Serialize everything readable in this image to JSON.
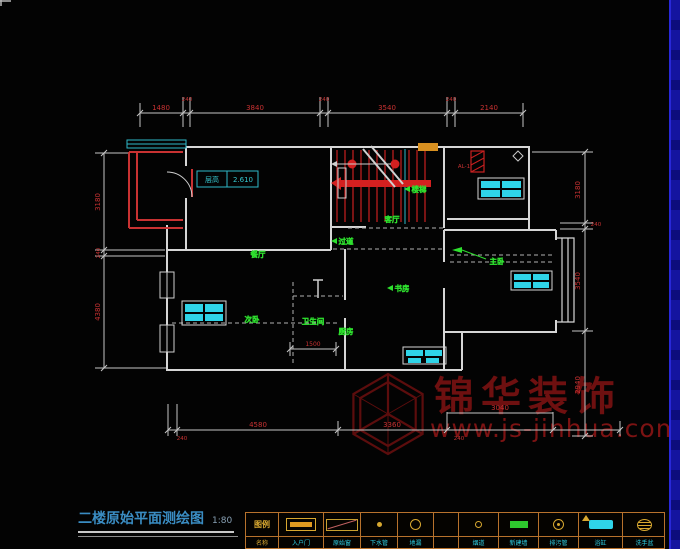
{
  "meta": {
    "title": "二楼原始平面测绘图",
    "scale": "1:80"
  },
  "height_note": {
    "label": "层高",
    "value": "2.610"
  },
  "flue_label": "AL-1",
  "rooms": [
    {
      "label": "餐厅"
    },
    {
      "label": "过道"
    },
    {
      "label": "客厅"
    },
    {
      "label": "楼梯"
    },
    {
      "label": "主卧"
    },
    {
      "label": "书房"
    },
    {
      "label": "卫生间"
    },
    {
      "label": "次卧"
    },
    {
      "label": "厨房"
    }
  ],
  "dims": {
    "top": [
      "1480",
      "240",
      "3840",
      "240",
      "3540",
      "240",
      "2140"
    ],
    "left": [
      "3180",
      "240",
      "4380"
    ],
    "right": [
      "3180",
      "240",
      "3540",
      "2940"
    ],
    "bottom": [
      "240",
      "4580",
      "3360",
      "3040",
      "240"
    ],
    "interior": [
      "1500"
    ]
  },
  "watermark": {
    "brand": "锦华装饰",
    "url": "www.js-jinhua.com"
  },
  "legend": {
    "items": [
      {
        "symbol": "label",
        "top": "图例",
        "name": "名称"
      },
      {
        "symbol": "door",
        "name": "入户门"
      },
      {
        "symbol": "window",
        "name": "原始窗"
      },
      {
        "symbol": "dot",
        "name": "下水管"
      },
      {
        "symbol": "circle",
        "name": "地漏"
      },
      {
        "symbol": "empty",
        "name": ""
      },
      {
        "symbol": "small-circle",
        "name": "烟道"
      },
      {
        "symbol": "green-rect",
        "name": "新建墙"
      },
      {
        "symbol": "circle-dot",
        "name": "排污管"
      },
      {
        "symbol": "bathtub",
        "name": "浴缸"
      },
      {
        "symbol": "basin",
        "name": "洗手盆"
      }
    ]
  },
  "colors": {
    "wall": "#d6d6d6",
    "dim_text": "#c83232",
    "room_label": "#2ee02e",
    "furniture": "#2fd4e8",
    "window_cyan": "#2fb8c8",
    "stair_red": "#d42020",
    "legend_border": "#b8722c",
    "symbol_yellow": "#d8a830",
    "title_blue": "#3a8cc2",
    "watermark_red": "#6e1010",
    "edge_blue": "#14149f"
  }
}
